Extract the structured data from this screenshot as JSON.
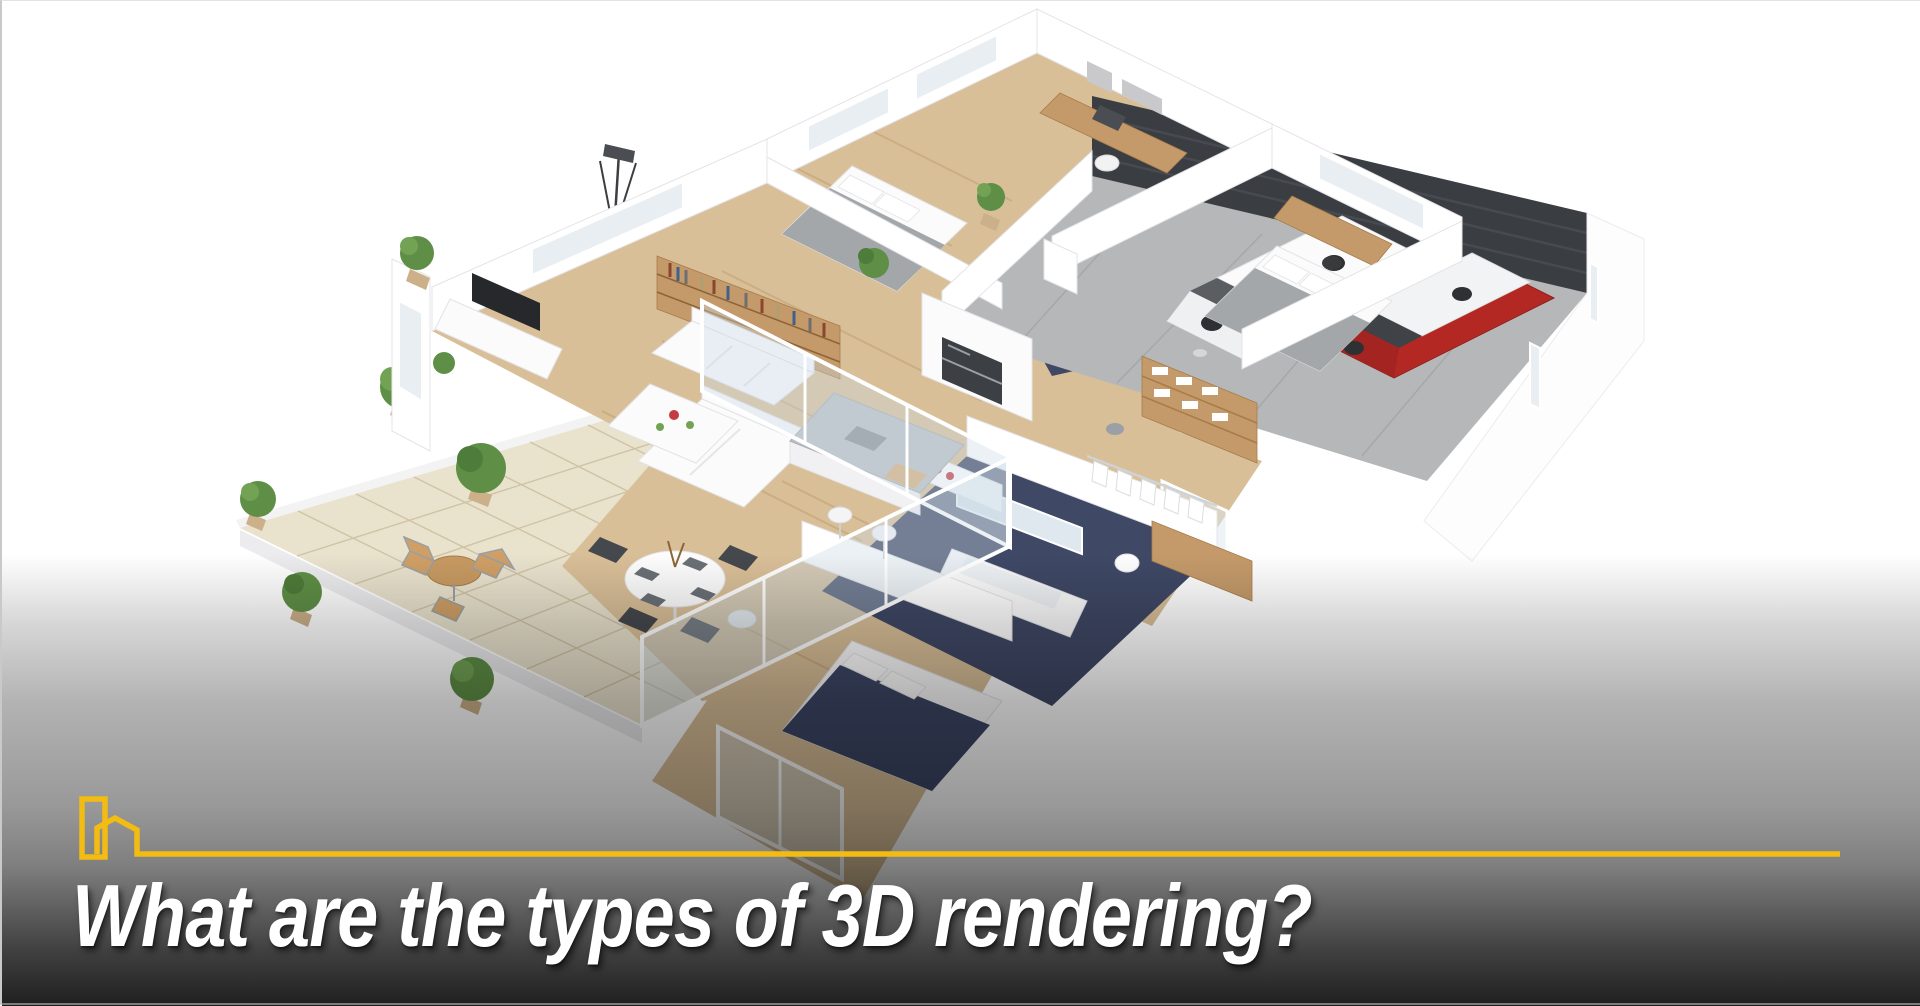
{
  "page": {
    "width": 1920,
    "height": 1005,
    "background": "#ffffff"
  },
  "hero": {
    "label": "3d-floor-plan-render",
    "description": "Isometric 3D rendered floor plan of a single-story house: two bedrooms, living room with white sofas and bookshelf, kitchen island, two navy-floored bathrooms, wardrobe room, dining table, tiled patio with plants, and a garage with a white SUV and a red car"
  },
  "footer": {
    "title": "What are the types of 3D rendering?",
    "icon": "building-house-outline-icon"
  },
  "theme": {
    "accent": "#F2BC13",
    "title-color": "#ffffff",
    "wood-floor": "#d9bf98",
    "navy-bath": "#3f4865",
    "garage-door": "#3a3d42",
    "garage-floor": "#b5b7b9",
    "patio-tile": "#e9e2cd",
    "car-red": "#b32823",
    "car-white": "#f4f5f6",
    "plant-green": "#5f8f46"
  }
}
